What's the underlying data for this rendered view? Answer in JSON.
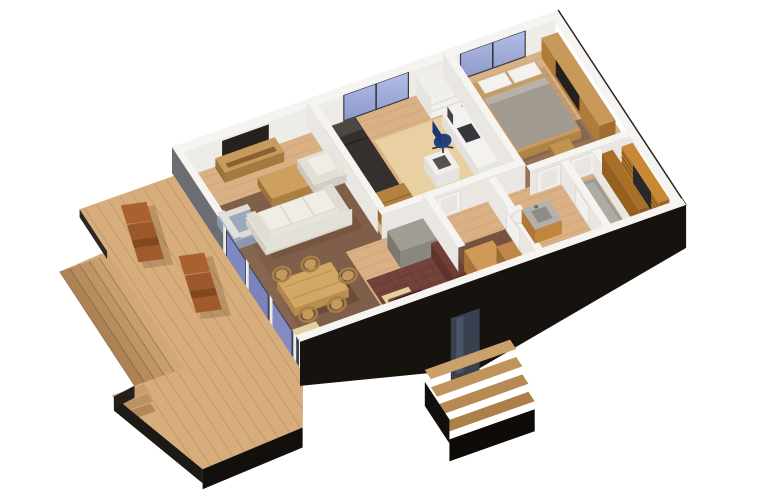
{
  "scene": {
    "description": "3D axonometric cutaway rendering of a single-storey house floor plan with furnished rooms, floor-to-ceiling glazing and a large timber terrace deck",
    "projection": "axonometric top-down cutaway",
    "background": "#ffffff"
  },
  "rooms": [
    {
      "id": "living-room",
      "label": "Living room"
    },
    {
      "id": "dining-area",
      "label": "Dining area"
    },
    {
      "id": "kitchen",
      "label": "Kitchen"
    },
    {
      "id": "study-bedroom",
      "label": "Study / second bedroom"
    },
    {
      "id": "master-bedroom",
      "label": "Master bedroom"
    },
    {
      "id": "hallway-entry",
      "label": "Hallway / entry"
    },
    {
      "id": "bathroom",
      "label": "Bathroom"
    },
    {
      "id": "shower-room",
      "label": "Shower room"
    },
    {
      "id": "walk-in-closet",
      "label": "Walk-in closet"
    },
    {
      "id": "terrace-deck",
      "label": "Timber terrace deck"
    },
    {
      "id": "entry-porch",
      "label": "Entry porch with steps"
    }
  ],
  "furniture": [
    "three-seat sofa",
    "cream armchair",
    "gray armchair",
    "coffee table",
    "TV sideboard",
    "wall-mounted TV",
    "dining table",
    "5 dining chairs",
    "kitchen island block",
    "kitchen counters",
    "cooktop",
    "single bed",
    "desk",
    "blue office chair",
    "bookshelf",
    "chest of drawers",
    "double bed",
    "wardrobe sideboard",
    "bedroom TV panel",
    "vanity sink",
    "toilet",
    "shower tray",
    "closet wardrobes",
    "mirror",
    "entry cabinets",
    "2 lounge chairs"
  ],
  "openings": {
    "north_windows": 2,
    "glass_wall_panels": 3,
    "front_door": 1,
    "interior_doors": 5,
    "deck_steps": 5,
    "porch_steps": 4
  },
  "colors": {
    "background": "#ffffff",
    "deck": "#d7ad7c",
    "deck_shadow": "#1b1713",
    "oak_floor": "#d9b184",
    "dark_floor": "#7a5a47",
    "hall_floor": "#6f4b3a",
    "bedroom_floor": "#8a684f",
    "kitchen_tile": "#73423a",
    "wall_top": "#f6f4f1",
    "wall_face": "#eae7e2",
    "wall_gray": "#6b6d72",
    "exterior_black": "#16120e",
    "window_glass": "#96a2d2",
    "glass_glow": "#8a94d7",
    "glass_dark": "#3f4450",
    "sofa_cream": "#e7e4dc",
    "cushion_white": "#f0ede6",
    "wood_light": "#cda05f",
    "wood_mid": "#b5813f",
    "wood_console": "#c89a5c",
    "wardrobe_orange": "#c98835",
    "blanket_gray": "#a19a90",
    "sheet_white": "#f4f2ee",
    "chair_blue": "#24407e",
    "lounge_brown": "#a9622f",
    "island_gray": "#a09c96",
    "counter_maroon": "#713f36",
    "cooktop_black": "#1f1b18",
    "rug_beige": "#e8d0a2",
    "mat_beige": "#e3cfa2",
    "shower_gray": "#a8a49e",
    "mirror_dark": "#27272c",
    "door_white": "#f2f0ed",
    "desk_white": "#f4f2ee",
    "porch_wood": "#c59a66"
  }
}
